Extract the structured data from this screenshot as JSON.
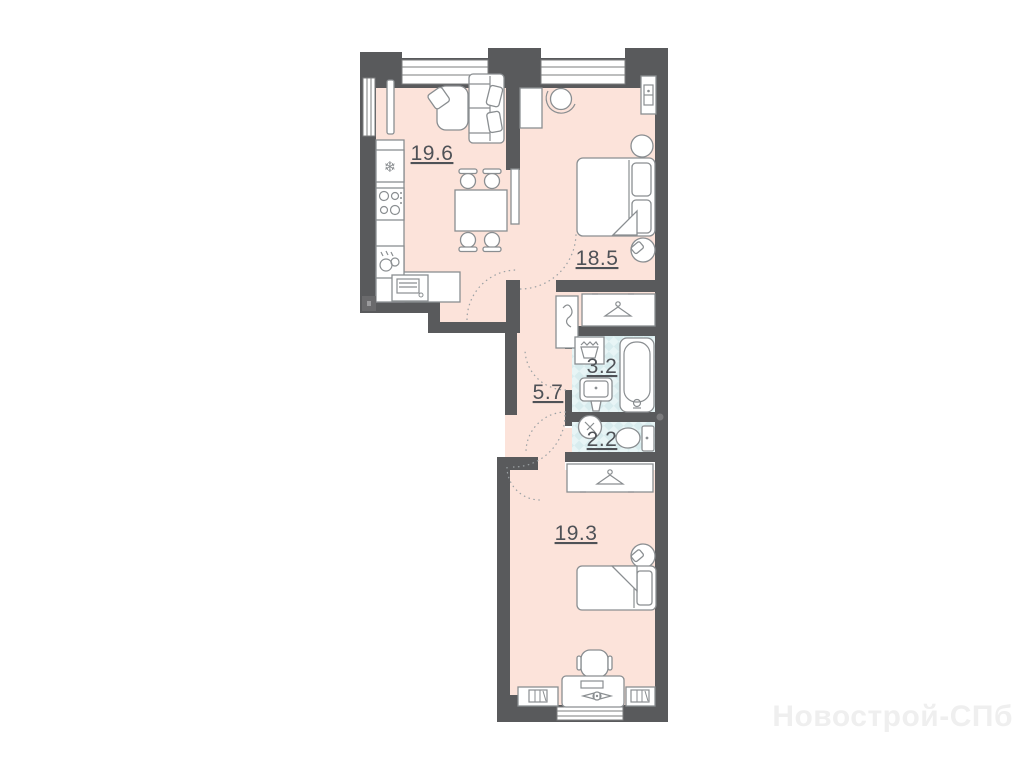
{
  "watermark": {
    "text": "Новострой-СПб"
  },
  "rooms": {
    "living_kitchen": {
      "label": "19.6"
    },
    "bedroom": {
      "label": "18.5"
    },
    "bathroom": {
      "label": "3.2"
    },
    "hallway": {
      "label": "5.7"
    },
    "toilet": {
      "label": "2.2"
    },
    "bedroom2": {
      "label": "19.3"
    }
  },
  "colors": {
    "room_fill": "#fce3da",
    "wet_room_fill": "#d8ecee",
    "wet_room_tile": "#e8f5f6",
    "wall": "#595a5c",
    "furniture_outline": "#8a8e91",
    "label_text": "#4f5257",
    "watermark_text": "#efefef"
  }
}
